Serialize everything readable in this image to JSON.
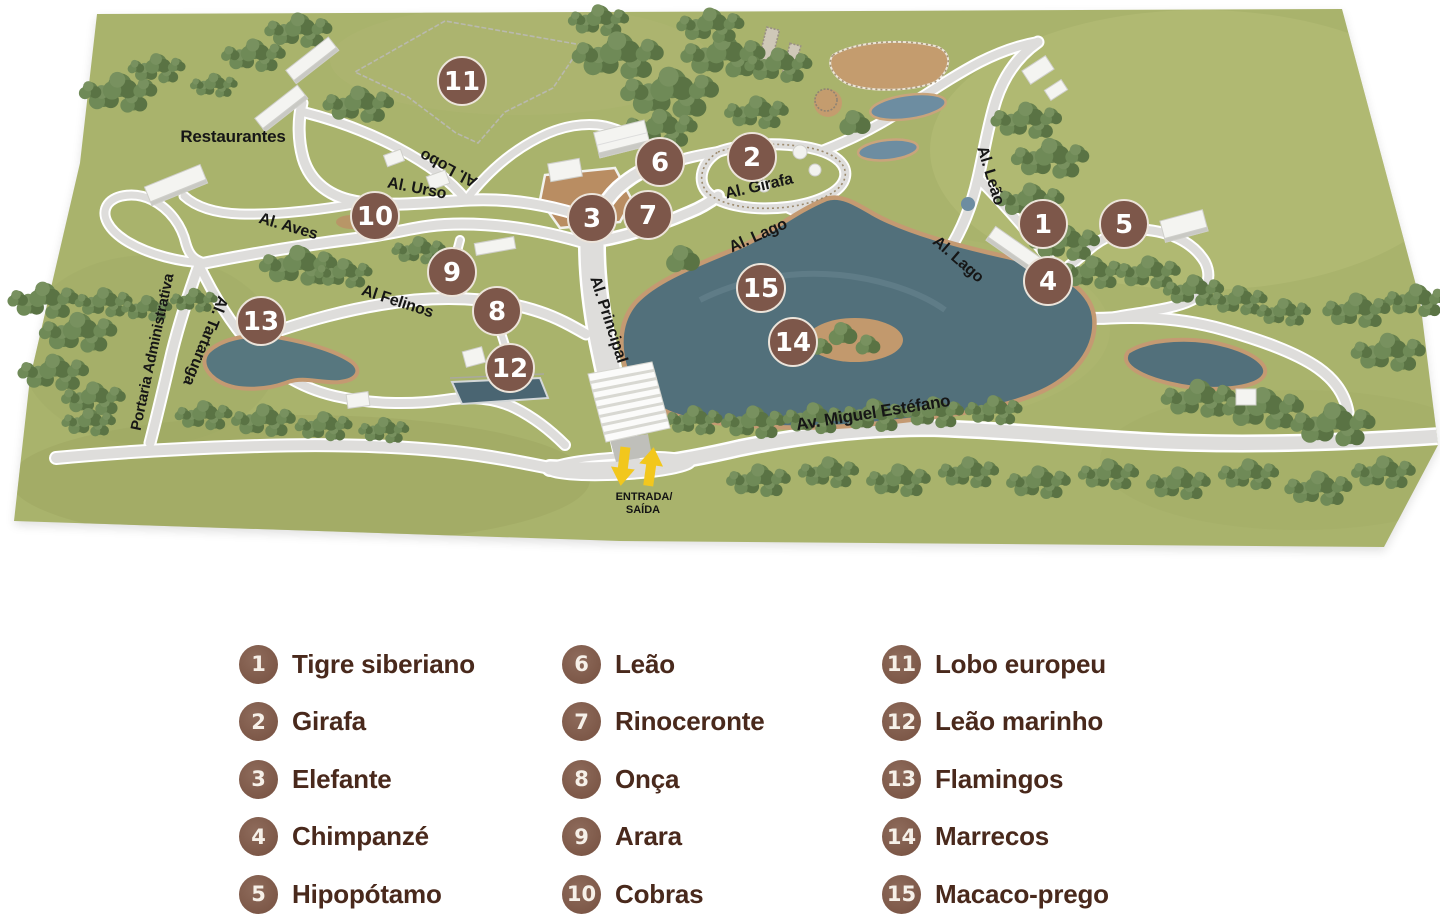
{
  "map": {
    "markers": [
      "1",
      "2",
      "3",
      "4",
      "5",
      "6",
      "7",
      "8",
      "9",
      "10",
      "11",
      "12",
      "13",
      "14",
      "15"
    ],
    "labels": {
      "restaurantes": "Restaurantes",
      "al_lobo": "Al. Lobo",
      "al_urso": "Al. Urso",
      "al_aves": "Al. Aves",
      "al_girafa": "Al. Girafa",
      "al_lago_1": "Al. Lago",
      "al_lago_2": "Al. Lago",
      "al_leao": "Al. Leão",
      "al_felinos": "Al Felinos",
      "al_principal": "Al. Principal",
      "al_tartaruga": "Al. Tartaruga",
      "portaria": "Portaria Administrativa",
      "av_miguel": "Av. Miguel Estéfano"
    },
    "entrance": {
      "line1": "ENTRADA/",
      "line2": "SAÍDA"
    }
  },
  "legend": {
    "columns": [
      {
        "items": [
          {
            "number": "1",
            "label": "Tigre siberiano"
          },
          {
            "number": "2",
            "label": "Girafa"
          },
          {
            "number": "3",
            "label": "Elefante"
          },
          {
            "number": "4",
            "label": "Chimpanzé"
          },
          {
            "number": "5",
            "label": "Hipopótamo"
          }
        ]
      },
      {
        "items": [
          {
            "number": "6",
            "label": "Leão"
          },
          {
            "number": "7",
            "label": "Rinoceronte"
          },
          {
            "number": "8",
            "label": "Onça"
          },
          {
            "number": "9",
            "label": "Arara"
          },
          {
            "number": "10",
            "label": "Cobras"
          }
        ]
      },
      {
        "items": [
          {
            "number": "11",
            "label": "Lobo europeu"
          },
          {
            "number": "12",
            "label": "Leão marinho"
          },
          {
            "number": "13",
            "label": "Flamingos"
          },
          {
            "number": "14",
            "label": "Marrecos"
          },
          {
            "number": "15",
            "label": "Macaco-prego"
          }
        ]
      }
    ]
  },
  "colors": {
    "grass": "#a9b36c",
    "lake": "#52707b",
    "sand_shore": "#c49a72",
    "path_gray": "#dedddb",
    "marker_brown": "#7d574a",
    "legend_circle": "#82604f",
    "legend_text": "#49291c",
    "label_black": "#161616",
    "arrow_yellow": "#f2c71d"
  }
}
